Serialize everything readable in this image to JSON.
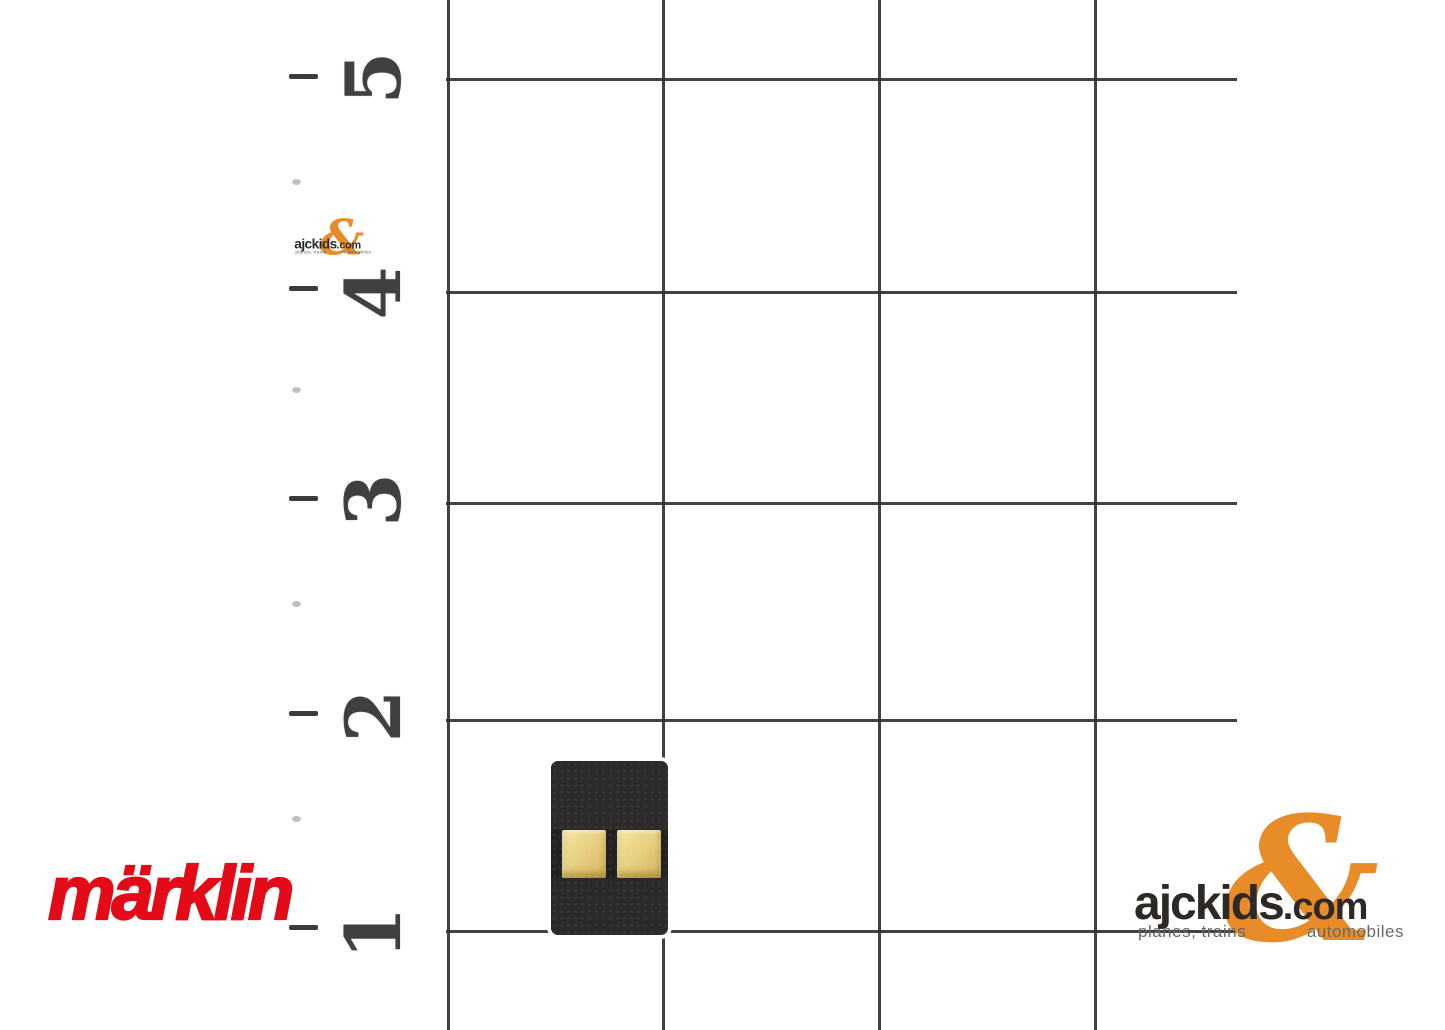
{
  "canvas": {
    "width": 1445,
    "height": 1030,
    "background": "#ffffff"
  },
  "ruler": {
    "labels": [
      {
        "value": "5"
      },
      {
        "value": "4"
      },
      {
        "value": "3"
      },
      {
        "value": "2"
      },
      {
        "value": "1"
      }
    ],
    "ink_color": "#413f3f"
  },
  "grid": {
    "line_color": "#333031"
  },
  "product": {
    "body_color": "#2c2a2b",
    "contact_color": "#e0c472"
  },
  "brand": {
    "wordmark": "märklin",
    "red": "#e30b17"
  },
  "retailer": {
    "name": "ajckids",
    "tld": ".com",
    "ampersand": "&",
    "tagline_left": "planes, trains",
    "tagline_right": "automobiles",
    "orange": "#e78c28",
    "ink": "#2d2926",
    "tagline_gray": "#6e6862"
  }
}
